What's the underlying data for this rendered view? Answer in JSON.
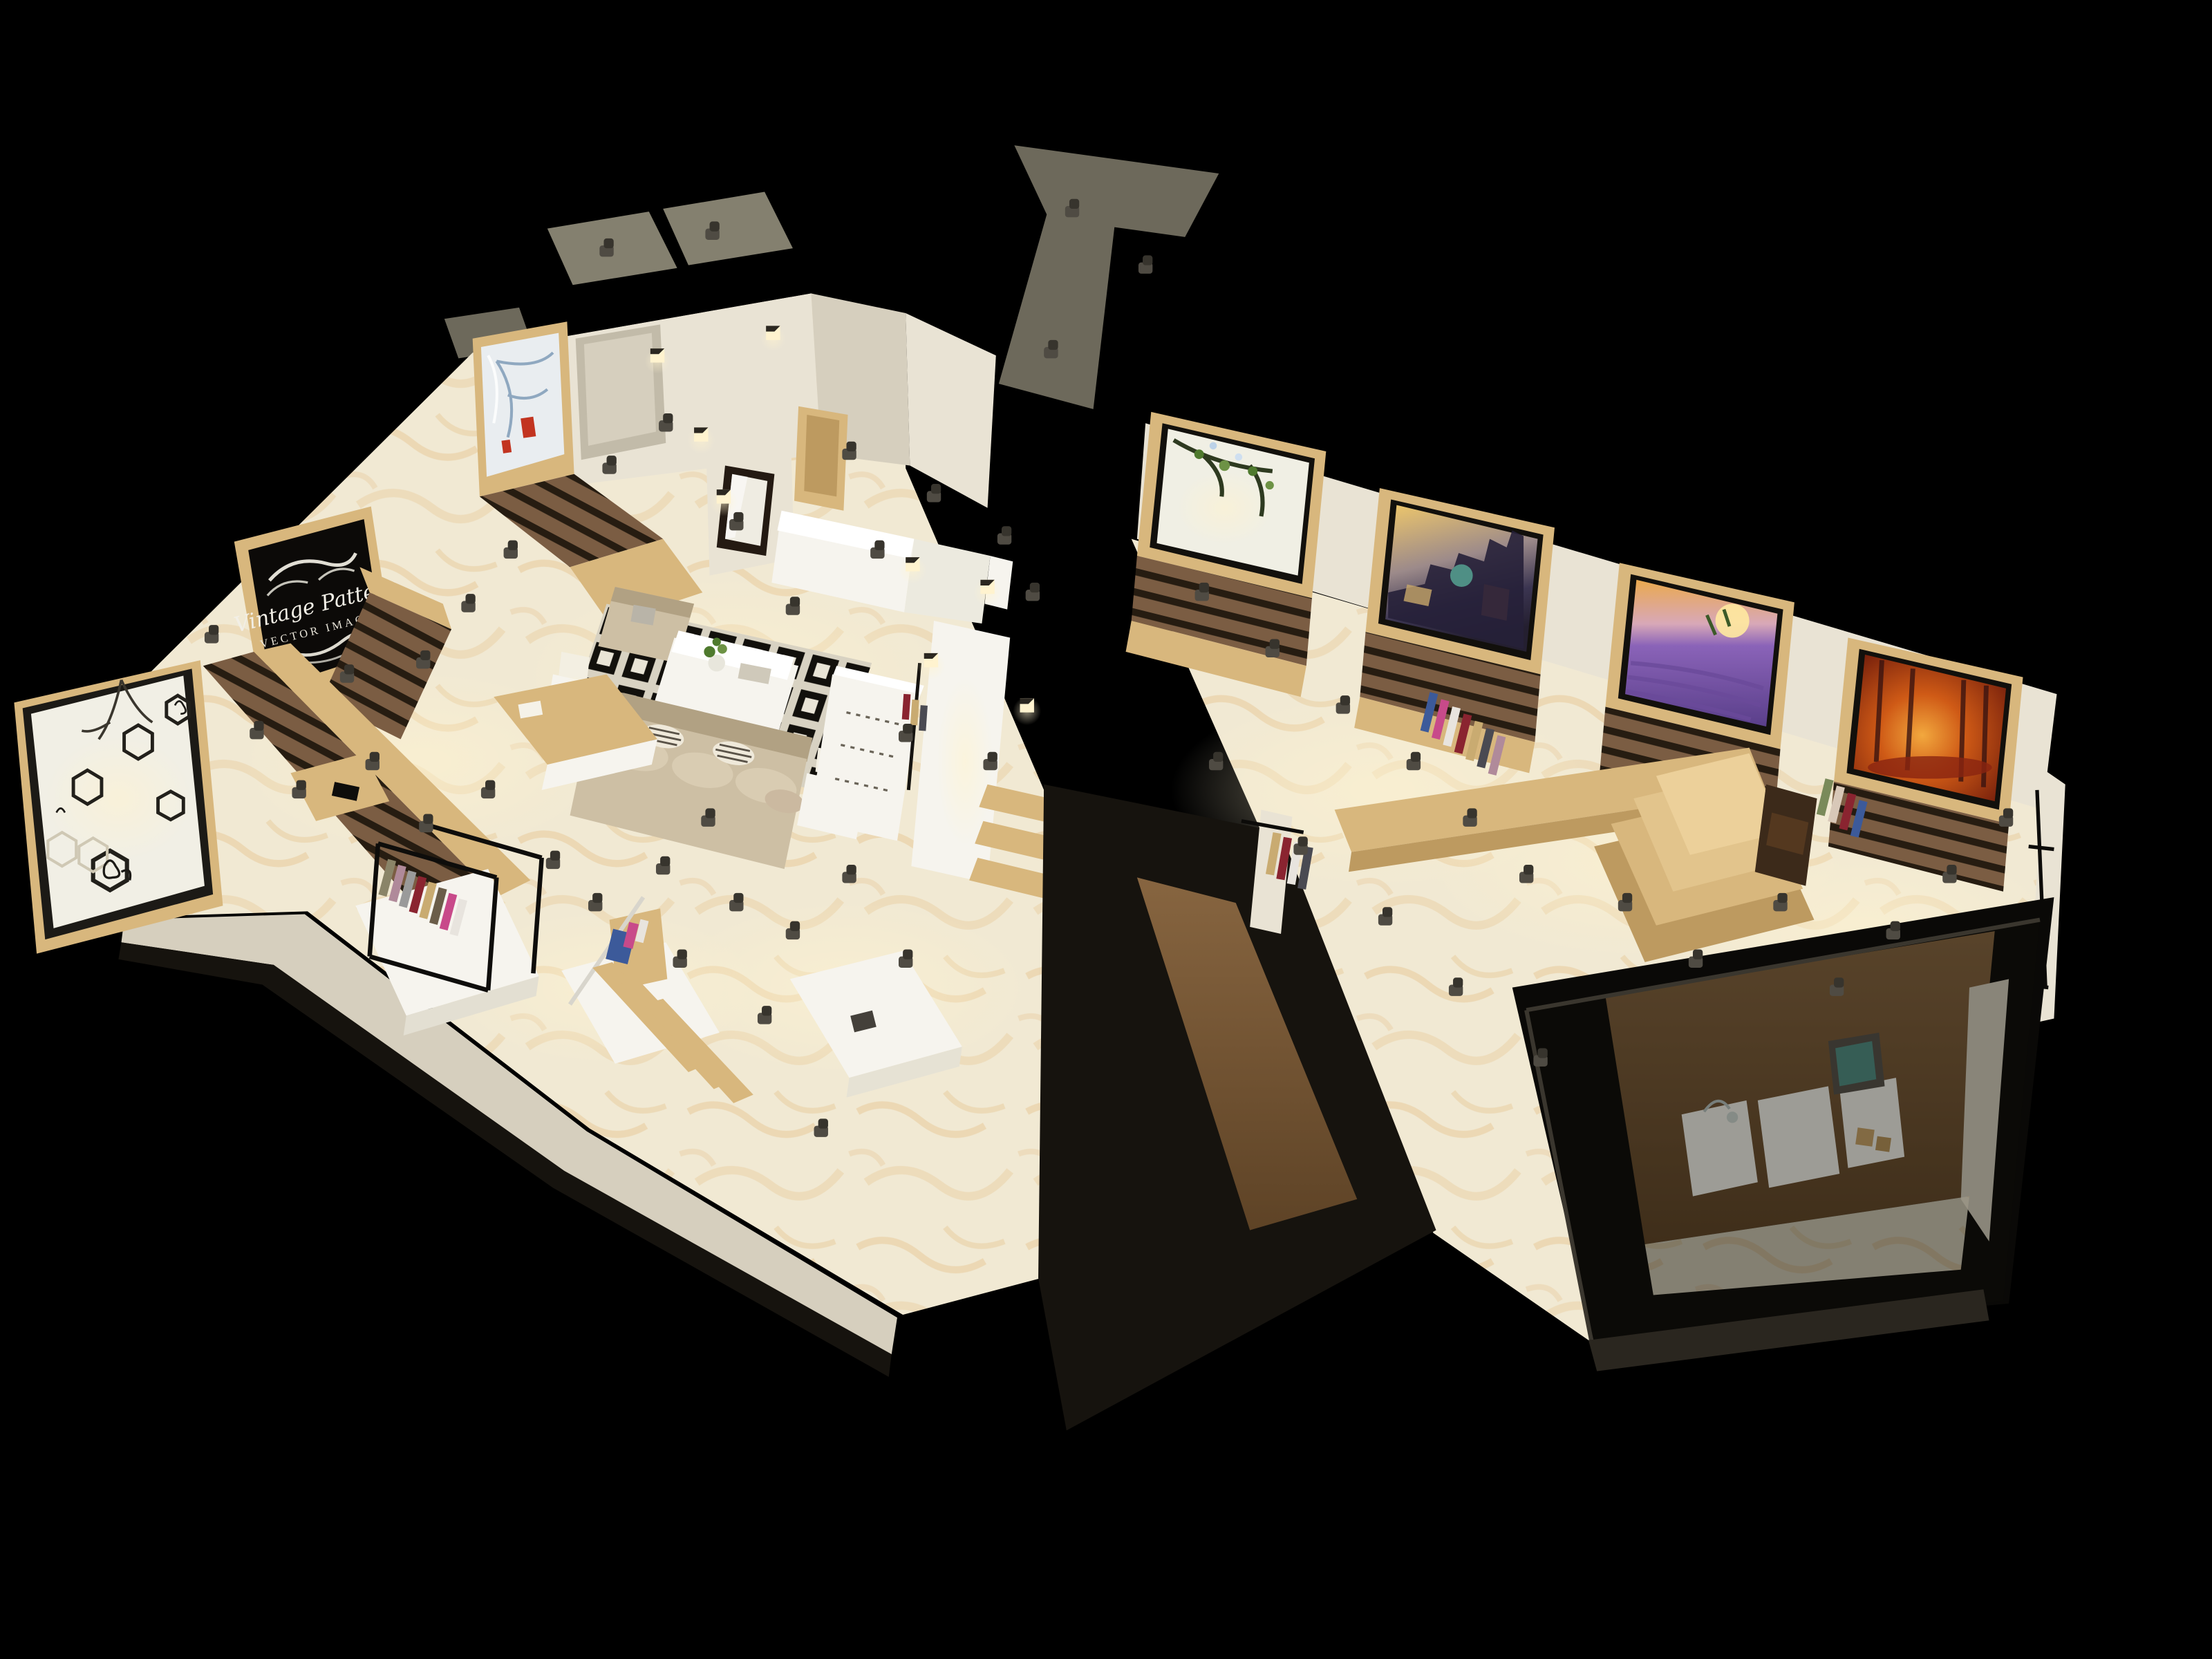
{
  "scene": {
    "type": "3d-interior-render",
    "description": "Isometric cutaway render of a retail clothing and accessories store at night, cream marble floors, wood display walls, spotlit",
    "background_color": "#000000"
  },
  "palette": {
    "bg": "#000000",
    "floor": "#f1e9d3",
    "floor2": "#fdf8ec",
    "vein": "#ddab63",
    "wall": "#e9e3d4",
    "wall2": "#d6cfbe",
    "wall3": "#c2bba9",
    "wood": "#d8b77d",
    "wood2": "#bd9a60",
    "wood3": "#93703f",
    "slat": "#7b5d43",
    "slat2": "#261c11",
    "dark": "#16130e",
    "dark2": "#2a261f",
    "black": "#0a0907",
    "white": "#f6f4ee",
    "sofa": "#cdbfa4",
    "sofa2": "#b1a183",
    "rug": "#d8d2c2",
    "roof": "#84806f",
    "roof2": "#6d695b",
    "spot": "#4f4b43",
    "spot2": "#37342d",
    "glow": "#fff3cf",
    "paper": "#f1efe5",
    "green": "#4f7a2e",
    "sky": "#eec76b",
    "dusk": "#3b3551",
    "teal": "#4f8f85",
    "lav": "#8a63b8",
    "lavsky": "#eaa94e",
    "aut": "#6f1b0b",
    "aut2": "#f2a83e",
    "deer": "#c23420"
  },
  "signage": {
    "line1": "Vintage Pattern",
    "line2": "VECTOR IMAGES"
  },
  "artworks": [
    {
      "name": "vintage-pattern-signboard",
      "style": "white ornate flourishes on black"
    },
    {
      "name": "hexagon-cat-display-wall",
      "style": "hexagon frames with cat silhouettes and branch art"
    },
    {
      "name": "winter-deer-painting",
      "style": "red deer with blue winter branches"
    },
    {
      "name": "spring-blossom-branch",
      "style": "green blossom branch on white"
    },
    {
      "name": "city-at-dusk",
      "style": "old-town skyline with domes at sunset"
    },
    {
      "name": "lavender-field-sunset",
      "style": "purple lavender rows under orange sky"
    },
    {
      "name": "autumn-forest",
      "style": "glowing orange-red autumn park"
    }
  ],
  "fixtures": {
    "ceiling_spotlights": 46,
    "wall_cube_lamps": 8,
    "floor_material": "cream marble with gold veining",
    "clothes_colors": [
      "#8a8468",
      "#c84a8a",
      "#9a9a9a",
      "#8a2430",
      "#c9ab71",
      "#3c5a9a",
      "#e8e4de",
      "#6b5d49",
      "#b08a9a",
      "#4a4a52"
    ]
  }
}
